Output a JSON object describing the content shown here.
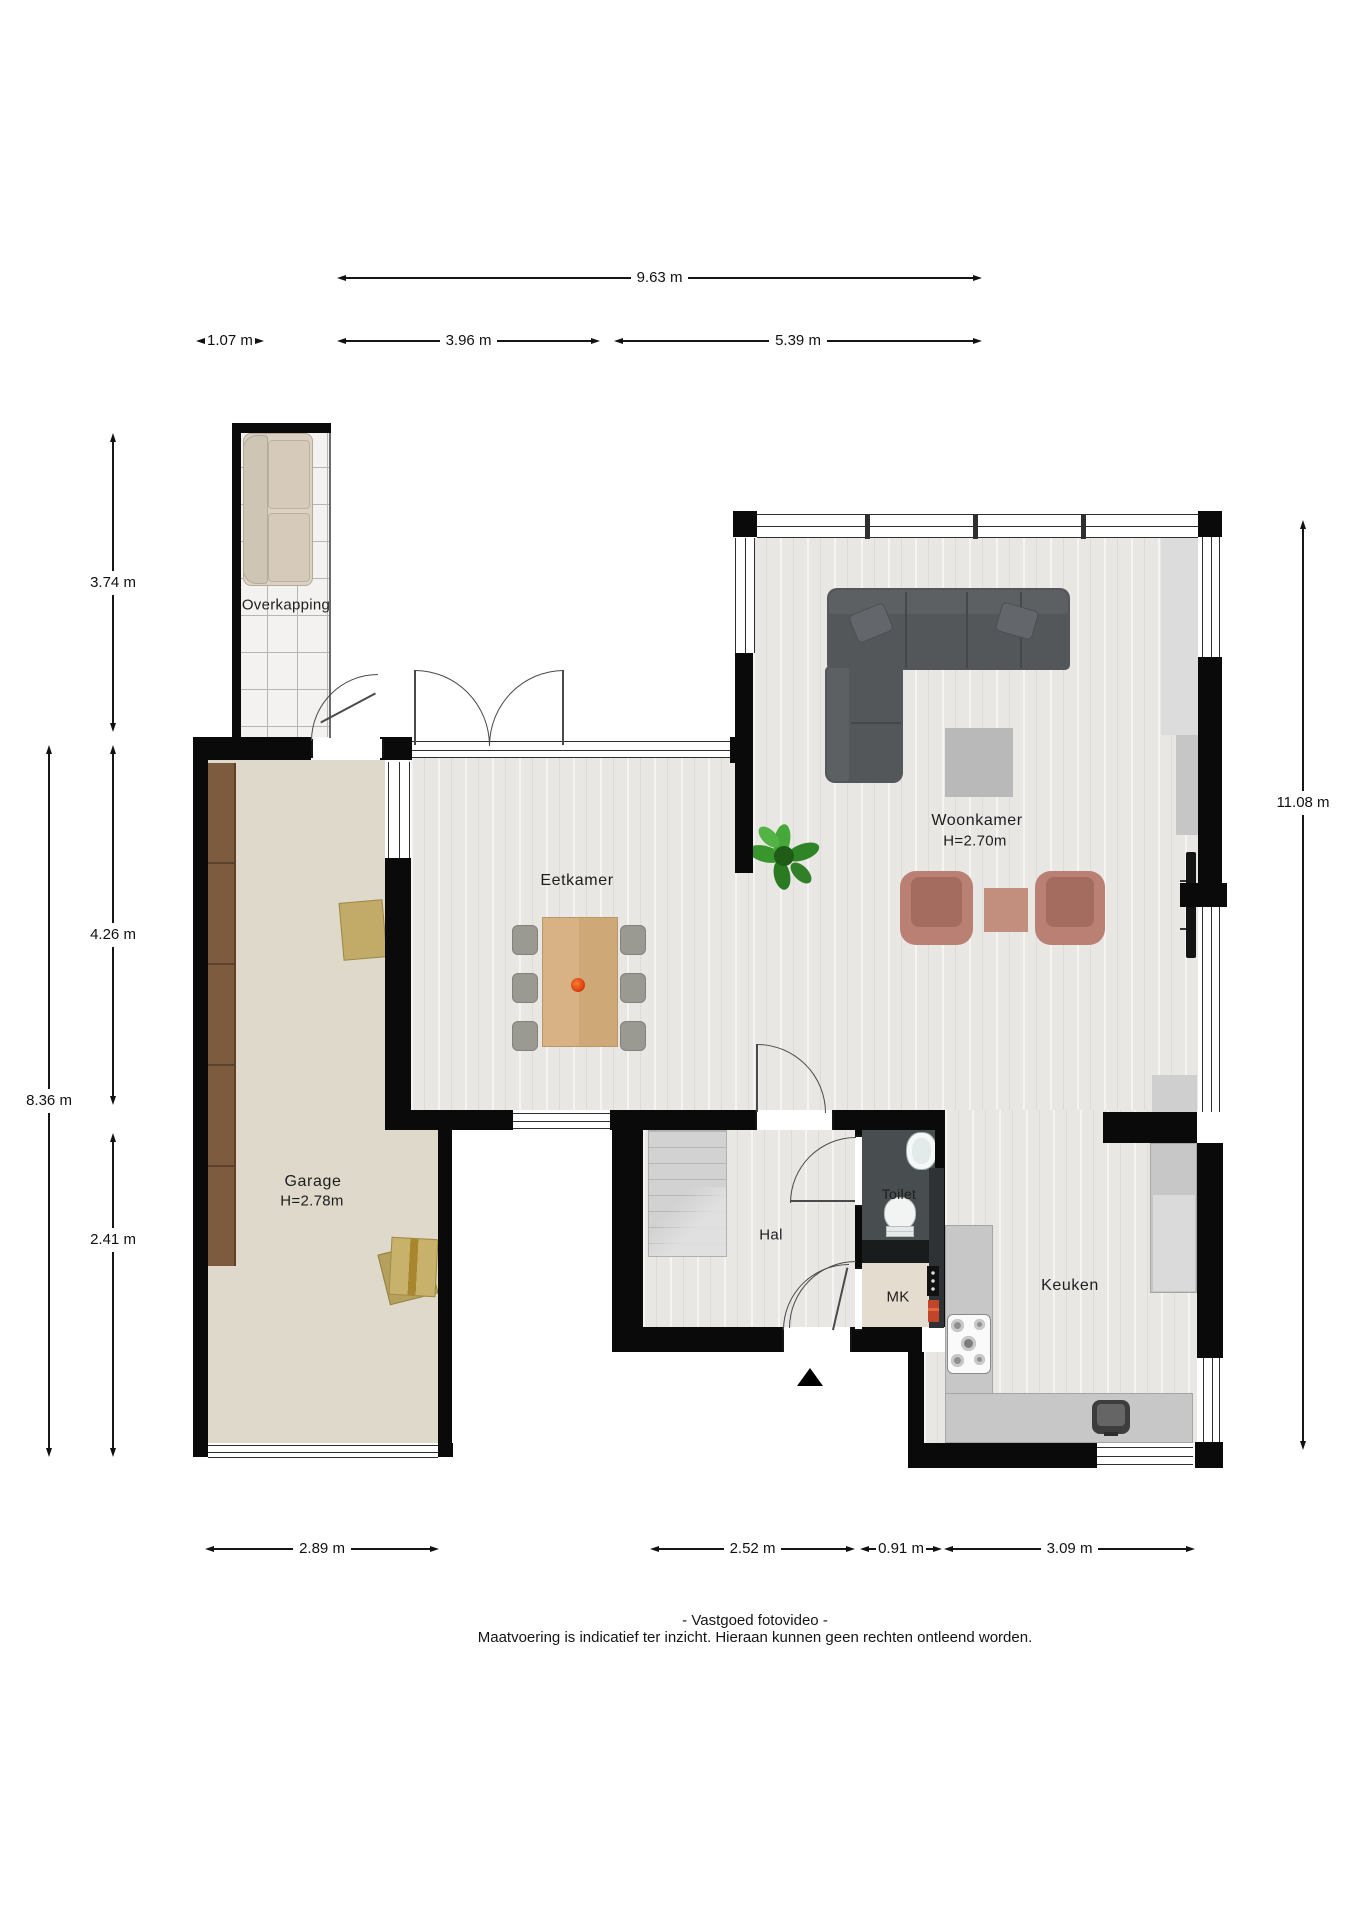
{
  "rooms": {
    "overkapping": {
      "name": "Overkapping"
    },
    "eetkamer": {
      "name": "Eetkamer"
    },
    "woonkamer": {
      "name": "Woonkamer",
      "height": "H=2.70m"
    },
    "garage": {
      "name": "Garage",
      "height": "H=2.78m"
    },
    "hal": {
      "name": "Hal"
    },
    "toilet": {
      "name": "Toilet"
    },
    "mk": {
      "name": "MK"
    },
    "keuken": {
      "name": "Keuken"
    }
  },
  "dimensions": {
    "top_total": "9.63 m",
    "top_left": "1.07 m",
    "top_mid": "3.96 m",
    "top_right": "5.39 m",
    "left_upper": "3.74 m",
    "left_mid": "4.26 m",
    "left_total": "8.36 m",
    "left_lower": "2.41 m",
    "right_total": "11.08 m",
    "bottom_garage": "2.89 m",
    "bottom_hal": "2.52 m",
    "bottom_mk": "0.91 m",
    "bottom_keuken": "3.09 m"
  },
  "footer": {
    "line1": "- Vastgoed fotovideo -",
    "line2": "Maatvoering is indicatief ter inzicht. Hieraan kunnen geen rechten ontleend worden."
  },
  "colors": {
    "wall": "#0a0a0a",
    "wood_floor": "#e8e7e4",
    "garage_floor": "#ded9ca",
    "tile_floor": "#f3f2f0",
    "toilet_floor": "#484e50",
    "mk_floor": "#e4ddcf",
    "counter": "#c7c7c7",
    "sofa": "#54575a",
    "armchair": "#b98073",
    "dining_table": "#d3ac7e",
    "cabinet_brown": "#7d5b3e",
    "plant": "#3c9030",
    "stairs": "#d2d2d2",
    "accent_flower": "#e8490f"
  }
}
